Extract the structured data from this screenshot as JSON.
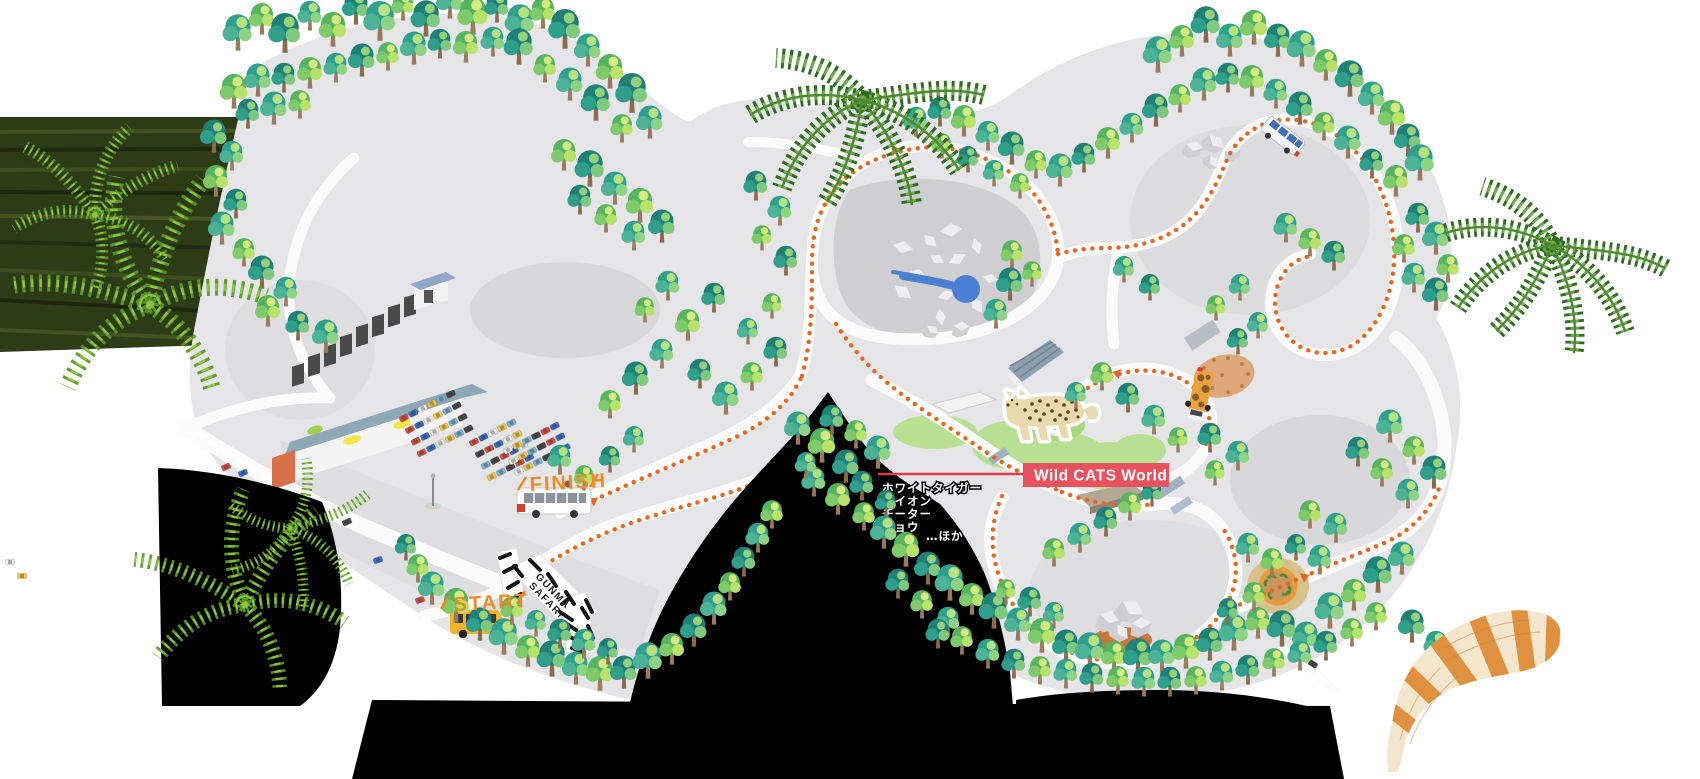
{
  "labels": {
    "area_label": "Wild CATS World",
    "start": "START",
    "finish": "FINISH",
    "gate_line1": "GUNMA",
    "gate_line2": "SAFARI"
  },
  "animal_list": {
    "items": [
      "ホワイトタイガー",
      "ライオン",
      "チーター",
      "ヒョウ"
    ],
    "more": "…ほか"
  },
  "colors": {
    "area_label_bg": "#e8515e",
    "area_label_line": "#e23b4e",
    "route_orange": "#e8661c",
    "start_finish_orange": "#ee8a21",
    "map_base": "#e5e5e7",
    "water_blue": "#4a80d2",
    "grass_green": "#b7e093",
    "hole_black": "#000000"
  },
  "icons": [
    "leopard-icon",
    "safari-gate-icon",
    "start-bus-icon",
    "finish-bus-icon",
    "tour-bus-icon",
    "safari-truck-icon",
    "water-pond-icon",
    "rock-icon",
    "tree-icon",
    "fern-icon",
    "palm-icon",
    "red-panda-tail-icon",
    "flagpole-icon",
    "feeding-circle-icon",
    "parking-car-icon"
  ],
  "car_colors": [
    "#d94f43",
    "#3a6fc4",
    "#f0f0f0",
    "#f2c84b",
    "#7fb3d5",
    "#4a4a4a"
  ],
  "parking_lots": [
    {
      "x": 404,
      "y": 418,
      "rows": 4,
      "cols": 6,
      "dx": 10.5,
      "dy": 13,
      "angle": -27
    },
    {
      "x": 474,
      "y": 442,
      "rows": 4,
      "cols": 5,
      "dx": 10.5,
      "dy": 13,
      "angle": -27
    },
    {
      "x": 508,
      "y": 450,
      "rows": 3,
      "cols": 6,
      "dx": 10.5,
      "dy": 12,
      "angle": -27
    }
  ],
  "street_cars": [
    [
      226,
      467,
      -25
    ],
    [
      243,
      473,
      -25
    ],
    [
      262,
      498,
      -25
    ],
    [
      288,
      502,
      -25
    ],
    [
      312,
      505,
      -25
    ],
    [
      347,
      522,
      -25
    ],
    [
      420,
      600,
      -18
    ],
    [
      378,
      560,
      -20
    ],
    [
      10,
      562,
      0
    ],
    [
      22,
      576,
      0
    ],
    [
      1303,
      655,
      32
    ],
    [
      1313,
      664,
      32
    ]
  ],
  "trees": [
    [
      238,
      50,
      1.1,
      0
    ],
    [
      262,
      34,
      1,
      1
    ],
    [
      285,
      52,
      1.2,
      2
    ],
    [
      310,
      30,
      0.9,
      0
    ],
    [
      333,
      46,
      1.1,
      1
    ],
    [
      356,
      24,
      1,
      2
    ],
    [
      380,
      40,
      1.2,
      0
    ],
    [
      403,
      20,
      0.9,
      1
    ],
    [
      426,
      36,
      1.1,
      2
    ],
    [
      450,
      18,
      1,
      0
    ],
    [
      473,
      34,
      1.2,
      1
    ],
    [
      497,
      22,
      0.9,
      2
    ],
    [
      520,
      40,
      1.1,
      0
    ],
    [
      543,
      28,
      1,
      1
    ],
    [
      565,
      48,
      1.2,
      2
    ],
    [
      588,
      66,
      1,
      0
    ],
    [
      610,
      88,
      1.1,
      1
    ],
    [
      632,
      112,
      1.2,
      2
    ],
    [
      650,
      138,
      1,
      0
    ],
    [
      622,
      142,
      0.9,
      1
    ],
    [
      596,
      120,
      1.1,
      2
    ],
    [
      570,
      100,
      1,
      0
    ],
    [
      545,
      82,
      0.9,
      1
    ],
    [
      519,
      64,
      1.1,
      2
    ],
    [
      493,
      56,
      0.9,
      0
    ],
    [
      466,
      62,
      1,
      1
    ],
    [
      440,
      58,
      0.9,
      2
    ],
    [
      414,
      64,
      1,
      0
    ],
    [
      388,
      70,
      0.9,
      1
    ],
    [
      362,
      76,
      1,
      2
    ],
    [
      336,
      82,
      0.9,
      0
    ],
    [
      310,
      88,
      1,
      1
    ],
    [
      284,
      92,
      0.9,
      2
    ],
    [
      258,
      96,
      1,
      0
    ],
    [
      234,
      108,
      1.1,
      1
    ],
    [
      248,
      128,
      0.9,
      2
    ],
    [
      274,
      124,
      1,
      0
    ],
    [
      300,
      118,
      0.9,
      1
    ],
    [
      214,
      152,
      1,
      2
    ],
    [
      232,
      170,
      0.9,
      0
    ],
    [
      216,
      196,
      1,
      1
    ],
    [
      236,
      218,
      0.9,
      2
    ],
    [
      222,
      244,
      1,
      0
    ],
    [
      244,
      266,
      0.9,
      1
    ],
    [
      262,
      288,
      1,
      2
    ],
    [
      286,
      306,
      0.9,
      0
    ],
    [
      268,
      326,
      1,
      1
    ],
    [
      298,
      340,
      0.9,
      2
    ],
    [
      326,
      352,
      1,
      0
    ],
    [
      564,
      170,
      1,
      1
    ],
    [
      590,
      186,
      1.1,
      2
    ],
    [
      615,
      204,
      1,
      0
    ],
    [
      640,
      222,
      1.1,
      1
    ],
    [
      662,
      242,
      1,
      2
    ],
    [
      634,
      250,
      0.9,
      0
    ],
    [
      606,
      232,
      0.9,
      1
    ],
    [
      580,
      214,
      0.9,
      2
    ],
    [
      610,
      418,
      0.9,
      1
    ],
    [
      636,
      394,
      1,
      2
    ],
    [
      662,
      368,
      0.9,
      0
    ],
    [
      688,
      340,
      1,
      1
    ],
    [
      714,
      312,
      0.9,
      2
    ],
    [
      668,
      300,
      0.9,
      0
    ],
    [
      645,
      322,
      0.8,
      1
    ],
    [
      700,
      388,
      0.9,
      2
    ],
    [
      726,
      414,
      1,
      0
    ],
    [
      752,
      390,
      0.9,
      1
    ],
    [
      776,
      366,
      0.9,
      2
    ],
    [
      748,
      344,
      0.8,
      0
    ],
    [
      772,
      318,
      0.8,
      1
    ],
    [
      756,
      200,
      0.9,
      2
    ],
    [
      780,
      225,
      0.9,
      0
    ],
    [
      762,
      250,
      0.8,
      1
    ],
    [
      786,
      275,
      0.9,
      2
    ],
    [
      1012,
      268,
      0.9,
      1
    ],
    [
      1010,
      300,
      1,
      2
    ],
    [
      996,
      328,
      0.9,
      0
    ],
    [
      1032,
      286,
      0.8,
      1
    ],
    [
      1102,
      390,
      0.9,
      1
    ],
    [
      1128,
      412,
      0.9,
      2
    ],
    [
      1154,
      434,
      0.9,
      0
    ],
    [
      1178,
      452,
      0.8,
      1
    ],
    [
      1076,
      408,
      0.8,
      0
    ],
    [
      1210,
      452,
      0.9,
      2
    ],
    [
      1238,
      470,
      0.9,
      0
    ],
    [
      1215,
      485,
      0.8,
      1
    ],
    [
      798,
      444,
      1,
      0
    ],
    [
      822,
      462,
      1.1,
      1
    ],
    [
      846,
      482,
      1,
      2
    ],
    [
      814,
      496,
      0.9,
      0
    ],
    [
      838,
      514,
      1,
      1
    ],
    [
      862,
      500,
      0.9,
      2
    ],
    [
      878,
      468,
      1,
      0
    ],
    [
      856,
      448,
      0.9,
      1
    ],
    [
      832,
      434,
      0.9,
      2
    ],
    [
      806,
      478,
      0.8,
      0
    ],
    [
      864,
      530,
      0.9,
      1
    ],
    [
      886,
      516,
      0.8,
      2
    ],
    [
      884,
      548,
      1,
      0
    ],
    [
      906,
      566,
      1.1,
      1
    ],
    [
      928,
      584,
      1,
      2
    ],
    [
      950,
      600,
      1.1,
      0
    ],
    [
      972,
      614,
      1,
      1
    ],
    [
      994,
      628,
      1.1,
      2
    ],
    [
      948,
      636,
      0.9,
      0
    ],
    [
      922,
      618,
      0.9,
      1
    ],
    [
      898,
      598,
      0.9,
      2
    ],
    [
      1018,
      640,
      1,
      0
    ],
    [
      1042,
      652,
      1.1,
      1
    ],
    [
      1066,
      662,
      1,
      2
    ],
    [
      1090,
      668,
      1.1,
      0
    ],
    [
      1114,
      672,
      1,
      1
    ],
    [
      1138,
      674,
      1.1,
      2
    ],
    [
      1162,
      672,
      1,
      0
    ],
    [
      1186,
      668,
      1.1,
      1
    ],
    [
      1210,
      660,
      1,
      2
    ],
    [
      1234,
      650,
      1.1,
      0
    ],
    [
      1258,
      638,
      1,
      1
    ],
    [
      1282,
      646,
      1.1,
      2
    ],
    [
      1306,
      654,
      1,
      0
    ],
    [
      1006,
      604,
      0.8,
      1
    ],
    [
      1030,
      616,
      0.9,
      2
    ],
    [
      1054,
      628,
      0.8,
      0
    ],
    [
      1254,
      610,
      0.9,
      1
    ],
    [
      1228,
      624,
      0.8,
      2
    ],
    [
      1014,
      678,
      0.9,
      2
    ],
    [
      988,
      668,
      0.9,
      0
    ],
    [
      962,
      654,
      0.9,
      1
    ],
    [
      938,
      648,
      0.9,
      2
    ],
    [
      1040,
      684,
      0.9,
      1
    ],
    [
      1066,
      688,
      0.9,
      0
    ],
    [
      1092,
      692,
      0.9,
      2
    ],
    [
      1118,
      694,
      0.9,
      1
    ],
    [
      1144,
      696,
      0.9,
      0
    ],
    [
      1170,
      696,
      0.9,
      2
    ],
    [
      1196,
      694,
      0.9,
      1
    ],
    [
      1222,
      690,
      0.9,
      0
    ],
    [
      1248,
      684,
      0.9,
      2
    ],
    [
      1274,
      676,
      0.9,
      1
    ],
    [
      1300,
      670,
      0.9,
      0
    ],
    [
      1326,
      660,
      0.9,
      2
    ],
    [
      1330,
      628,
      1.1,
      0
    ],
    [
      1354,
      610,
      1,
      1
    ],
    [
      1378,
      592,
      1.1,
      2
    ],
    [
      1402,
      574,
      1,
      0
    ],
    [
      1352,
      646,
      0.9,
      1
    ],
    [
      1376,
      630,
      0.9,
      1
    ],
    [
      1412,
      642,
      1,
      2
    ],
    [
      1436,
      660,
      0.9,
      0
    ],
    [
      432,
      604,
      1,
      0
    ],
    [
      456,
      622,
      1.1,
      1
    ],
    [
      480,
      640,
      1,
      2
    ],
    [
      504,
      654,
      1.1,
      0
    ],
    [
      528,
      666,
      1,
      1
    ],
    [
      552,
      676,
      1.1,
      2
    ],
    [
      576,
      684,
      1,
      0
    ],
    [
      600,
      690,
      1.1,
      1
    ],
    [
      624,
      688,
      1,
      2
    ],
    [
      648,
      678,
      1.1,
      0
    ],
    [
      672,
      664,
      1,
      1
    ],
    [
      694,
      646,
      1,
      2
    ],
    [
      714,
      624,
      1,
      0
    ],
    [
      730,
      600,
      0.9,
      1
    ],
    [
      744,
      576,
      0.9,
      2
    ],
    [
      758,
      552,
      0.9,
      0
    ],
    [
      772,
      528,
      0.9,
      1
    ],
    [
      560,
      648,
      0.9,
      2
    ],
    [
      536,
      636,
      0.8,
      0
    ],
    [
      512,
      624,
      0.9,
      1
    ],
    [
      584,
      658,
      0.9,
      0
    ],
    [
      608,
      664,
      0.8,
      2
    ],
    [
      418,
      582,
      0.9,
      1
    ],
    [
      406,
      560,
      0.8,
      2
    ],
    [
      560,
      474,
      0.9,
      0
    ],
    [
      584,
      490,
      0.8,
      1
    ],
    [
      610,
      472,
      0.8,
      2
    ],
    [
      634,
      452,
      0.8,
      0
    ],
    [
      1158,
      72,
      1.1,
      0
    ],
    [
      1182,
      56,
      1,
      1
    ],
    [
      1206,
      42,
      1.1,
      2
    ],
    [
      1230,
      56,
      1,
      0
    ],
    [
      1254,
      44,
      1.1,
      1
    ],
    [
      1278,
      56,
      1,
      2
    ],
    [
      1302,
      66,
      1.1,
      0
    ],
    [
      1326,
      80,
      1,
      1
    ],
    [
      1350,
      96,
      1.1,
      2
    ],
    [
      1372,
      114,
      1,
      0
    ],
    [
      1392,
      134,
      1.1,
      1
    ],
    [
      1408,
      156,
      1,
      2
    ],
    [
      1420,
      180,
      1.1,
      0
    ],
    [
      1396,
      196,
      1,
      1
    ],
    [
      1372,
      178,
      0.9,
      2
    ],
    [
      1348,
      158,
      1,
      0
    ],
    [
      1324,
      140,
      0.9,
      1
    ],
    [
      1300,
      124,
      1,
      2
    ],
    [
      1276,
      108,
      0.9,
      0
    ],
    [
      1252,
      96,
      1,
      1
    ],
    [
      1228,
      92,
      0.9,
      2
    ],
    [
      1204,
      100,
      1,
      0
    ],
    [
      1180,
      112,
      0.9,
      1
    ],
    [
      1156,
      126,
      1,
      2
    ],
    [
      1132,
      142,
      0.9,
      0
    ],
    [
      1108,
      158,
      1,
      1
    ],
    [
      1084,
      172,
      0.9,
      2
    ],
    [
      1060,
      186,
      1,
      0
    ],
    [
      1036,
      178,
      0.9,
      1
    ],
    [
      1012,
      164,
      1,
      2
    ],
    [
      988,
      150,
      0.9,
      0
    ],
    [
      964,
      136,
      1,
      1
    ],
    [
      940,
      126,
      0.9,
      2
    ],
    [
      916,
      136,
      0.9,
      0
    ],
    [
      942,
      158,
      0.8,
      1
    ],
    [
      968,
      172,
      0.8,
      2
    ],
    [
      994,
      186,
      0.8,
      0
    ],
    [
      1020,
      198,
      0.8,
      1
    ],
    [
      1436,
      254,
      1,
      0
    ],
    [
      1448,
      282,
      0.9,
      1
    ],
    [
      1436,
      310,
      1,
      2
    ],
    [
      1414,
      292,
      0.9,
      0
    ],
    [
      1404,
      262,
      0.9,
      1
    ],
    [
      1418,
      232,
      0.9,
      2
    ],
    [
      1286,
      242,
      0.9,
      0
    ],
    [
      1310,
      256,
      0.9,
      1
    ],
    [
      1334,
      270,
      0.9,
      2
    ],
    [
      1390,
      442,
      1,
      0
    ],
    [
      1414,
      464,
      0.9,
      1
    ],
    [
      1434,
      488,
      1,
      2
    ],
    [
      1408,
      508,
      0.9,
      0
    ],
    [
      1382,
      486,
      0.9,
      1
    ],
    [
      1358,
      466,
      0.9,
      2
    ],
    [
      1336,
      542,
      0.9,
      0
    ],
    [
      1310,
      528,
      0.9,
      1
    ],
    [
      1240,
      300,
      0.8,
      0
    ],
    [
      1216,
      320,
      0.8,
      1
    ],
    [
      1150,
      300,
      0.8,
      2
    ],
    [
      1124,
      282,
      0.8,
      0
    ],
    [
      1238,
      354,
      0.8,
      2
    ],
    [
      1258,
      338,
      0.8,
      0
    ],
    [
      1130,
      520,
      0.9,
      1
    ],
    [
      1106,
      536,
      0.9,
      2
    ],
    [
      1080,
      552,
      0.9,
      0
    ],
    [
      1054,
      566,
      0.9,
      1
    ],
    [
      1152,
      506,
      0.8,
      2
    ],
    [
      1248,
      562,
      0.9,
      0
    ],
    [
      1272,
      576,
      0.9,
      1
    ],
    [
      1296,
      560,
      0.8,
      2
    ],
    [
      1320,
      574,
      0.9,
      0
    ]
  ]
}
